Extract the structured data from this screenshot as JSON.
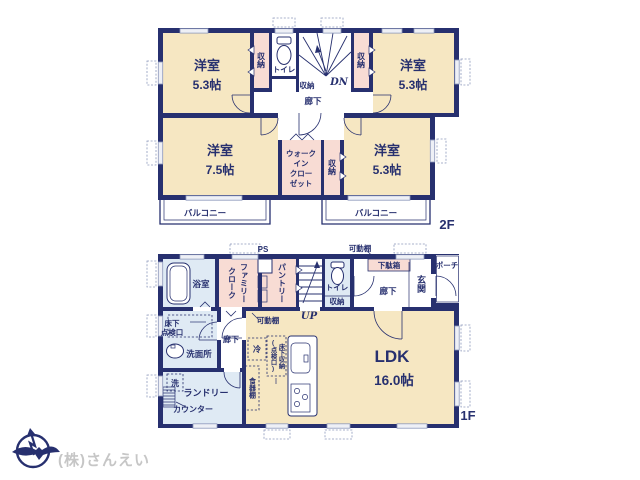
{
  "colors": {
    "wall": "#27306f",
    "room": "#f6e7c2",
    "closet": "#f8dcd4",
    "wet": "#dfeaf4",
    "winframe": "#8d98bb",
    "company": "#c6c6c6"
  },
  "floor2": {
    "label": "2F",
    "rooms": {
      "bedroom_tl_name": "洋室",
      "bedroom_tl_size": "5.3帖",
      "bedroom_tr_name": "洋室",
      "bedroom_tr_size": "5.3帖",
      "bedroom_bl_name": "洋室",
      "bedroom_bl_size": "7.5帖",
      "bedroom_br_name": "洋室",
      "bedroom_br_size": "5.3帖",
      "closet_left": "収納",
      "closet_right": "収納",
      "closet_small": "収納",
      "closet_hall": "収納",
      "toilet": "トイレ",
      "hallway": "廊下",
      "stairs": "DN",
      "wic_lines": [
        "ウォーク",
        "イン",
        "クロー",
        "ゼット"
      ],
      "balcony_left": "バルコニー",
      "balcony_right": "バルコニー"
    }
  },
  "floor1": {
    "label": "1F",
    "rooms": {
      "bath": "浴室",
      "family_cloak": [
        "ファミリー",
        "クローク"
      ],
      "ps": "PS",
      "pantry": "パントリー",
      "stairs": "UP",
      "toilet": "トイレ",
      "toilet_storage": "収納",
      "shelf_top": "可動棚",
      "shoe_cabinet": "下駄箱",
      "hall": "廊下",
      "entrance": "玄関",
      "porch": "ポーチ",
      "underfloor_check": [
        "床下",
        "点検口"
      ],
      "washroom": "洗面所",
      "hall2": "廊下",
      "washer": "洗",
      "laundry": "ランドリー",
      "laundry_counter": "カウンター",
      "shelf_mid": "可動棚",
      "fridge": "冷",
      "underfloor_storage": [
        "床下収納",
        "(点検口)"
      ],
      "cupboard": "食器棚",
      "ldk_name": "LDK",
      "ldk_size": "16.0帖"
    }
  },
  "footer": {
    "company": "(株)さんえい"
  }
}
